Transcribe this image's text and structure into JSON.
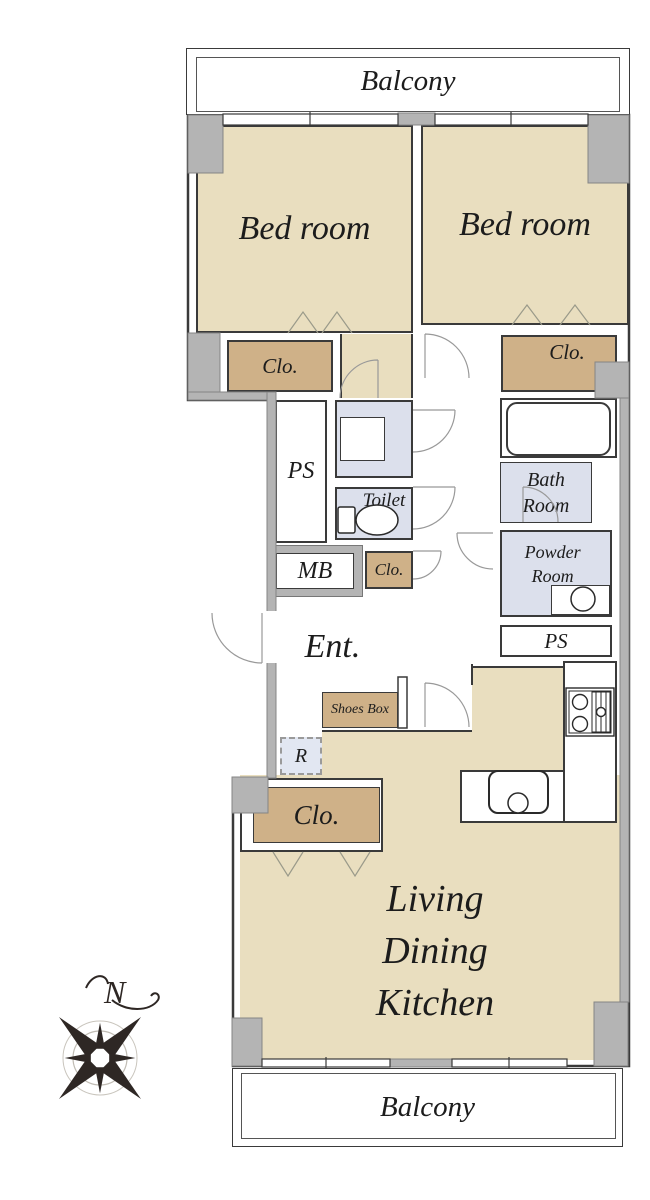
{
  "title": "Apartment floor plan",
  "colors": {
    "room_fill": "#e9debf",
    "closet_fill": "#cfb188",
    "wet_room_fill": "#dce0ec",
    "refrigerator_fill": "#e2e7f2",
    "wall_gray": "#b4b4b4",
    "outline": "#3a3a3a",
    "door_arc": "#999999"
  },
  "labels": {
    "balcony_top": "Balcony",
    "balcony_bottom": "Balcony",
    "bedroom_left": "Bed room",
    "bedroom_right": "Bed room",
    "clo_left": "Clo.",
    "clo_right": "Clo.",
    "clo_hall": "Clo.",
    "clo_ldk": "Clo.",
    "ps_left": "PS",
    "ps_right": "PS",
    "toilet": "Toilet",
    "mb": "MB",
    "bath_line1": "Bath",
    "bath_line2": "Room",
    "powder_line1": "Powder",
    "powder_line2": "Room",
    "entrance": "Ent.",
    "shoes_box": "Shoes Box",
    "refrigerator": "R",
    "ldk_line1": "Living",
    "ldk_line2": "Dining",
    "ldk_line3": "Kitchen",
    "compass_north": "N"
  }
}
